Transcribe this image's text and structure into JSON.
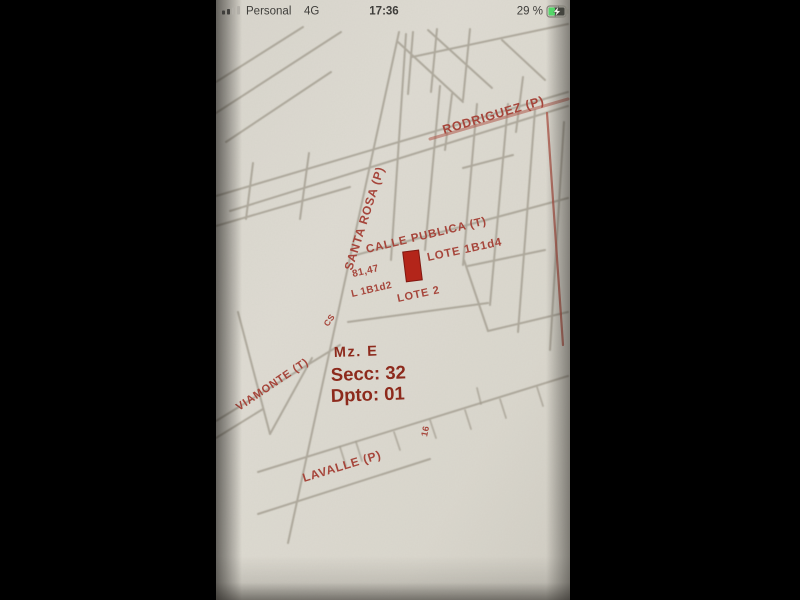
{
  "status_bar": {
    "carrier": "Personal",
    "network": "4G",
    "time": "17:36",
    "battery_percent": "29 %"
  },
  "map": {
    "streets": {
      "rodriguez": "RODRIGUEZ (P)",
      "santa_rosa": "SANTA ROSA (P)",
      "calle_publica": "CALLE PUBLICA (T)",
      "viamonte": "VIAMONTE (T)",
      "lavalle": "LAVALLE (P)"
    },
    "lots": {
      "dimension": "81,47",
      "lot_adjacent": "L 1B1d2",
      "lot_highlighted": "LOTE 1B1d4",
      "lote_2": "LOTE 2",
      "mark_16": "16",
      "mark_cs": "CS"
    },
    "parcel": {
      "manzana": "Mz. E",
      "seccion": "Secc: 32",
      "departamento": "Dpto: 01"
    },
    "colors": {
      "ink_red": "#a6453a",
      "ink_dark_red": "#8d2b1f",
      "pencil_gray": "#a29c8f",
      "paper": "#dcd9d0",
      "highlight_fill": "#b3251a",
      "battery_green": "#53d769"
    }
  }
}
